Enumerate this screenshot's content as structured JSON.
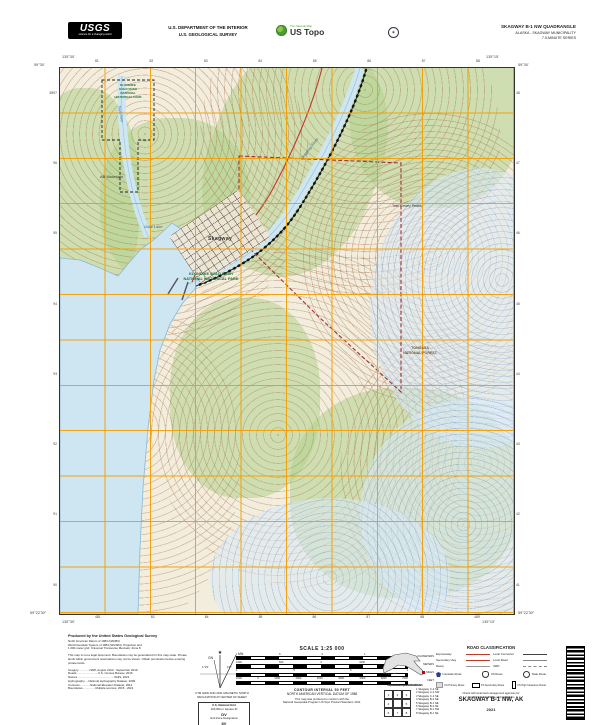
{
  "colors": {
    "grid_orange": "#F29F05",
    "water_blue": "#CDE6F2",
    "contour_brown": "#A9714B",
    "woodland_green": "#B1D18C",
    "park_green": "#1E6B2E",
    "boundary_red": "#A03232",
    "road_red": "#C0392B",
    "ustopo_green": "#4C9F38"
  },
  "header": {
    "usgs_logo": "USGS",
    "usgs_tagline": "science for a changing world",
    "dept_line1": "U.S. DEPARTMENT OF THE INTERIOR",
    "dept_line2": "U.S. GEOLOGICAL SURVEY",
    "ustopo_topline": "The National Map",
    "ustopo_brand": "US Topo",
    "quad_title": "SKAGWAY B-1 NW QUADRANGLE",
    "quad_subtitle1": "ALASKA - SKAGWAY MUNICIPALITY",
    "quad_subtitle2": "7.5-MINUTE SERIES"
  },
  "map": {
    "corners": {
      "tl_lat": "59°30'",
      "tl_lon": "135°30'",
      "tr_lat": "59°30'",
      "tr_lon": "135°15'",
      "bl_lat": "59°22'30\"",
      "bl_lon": "135°30'",
      "br_lat": "59°22'30\"",
      "br_lon": "135°15'"
    },
    "grid_labels": {
      "top": [
        "81",
        "82",
        "83",
        "84",
        "85",
        "86",
        "87",
        "88"
      ],
      "bottom": [
        "481",
        "83",
        "84",
        "85",
        "86",
        "87",
        "88",
        "489"
      ],
      "left": [
        "6597",
        "96",
        "95",
        "94",
        "93",
        "92",
        "91",
        "90"
      ],
      "right": [
        "48",
        "47",
        "46",
        "45",
        "44",
        "43",
        "42",
        "41"
      ]
    },
    "features": {
      "town": "Skagway",
      "goat_lake": "Goat Lake",
      "ab_mountain": "AB Mountain",
      "twin_dewey": "Twin Dewey Peaks",
      "skagway_river": "Skagway River",
      "taiya_river": "Taiya River",
      "park_lines": [
        "KLONDIKE",
        "GOLD RUSH",
        "NATIONAL",
        "HISTORICAL PARK"
      ],
      "park_main": [
        "KLONDIKE GOLD RUSH",
        "NATIONAL HISTORICAL PARK"
      ],
      "tongass": [
        "TONGASS",
        "NATIONAL FOREST"
      ]
    }
  },
  "footer": {
    "produced_by": "Produced by the United States Geological Survey",
    "datum_lines": [
      "North American Datum of 1983 (NAD83)",
      "World Geodetic System of 1984 (WGS84). Projection and",
      "1 000-meter grid: Universal Transverse Mercator, Zone 8"
    ],
    "disclaimer": "This map is not a legal document. Boundaries may be generalized for this map scale. Private lands within government reservations may not be shown. Obtain permission before entering private lands.",
    "credits": [
      "Imagery..............NAIP, August 2013 - September 2019",
      "Roads...........................U.S. Census Bureau, 2016",
      "Names..............................................GNIS, 2021",
      "Hydrography.....National Hydrography Dataset, 2009",
      "Contours.............National Elevation Dataset, 2012",
      "Boundaries................Multiple sources, 2015 - 2021"
    ],
    "declination": {
      "mn": "MN",
      "gn": "GN",
      "mn_angle": "19°",
      "gn_angle": "1°21'",
      "caption": [
        "UTM GRID AND 2021 MAGNETIC NORTH",
        "DECLINATION AT CENTER OF SHEET"
      ]
    },
    "usng": {
      "title": "U.S. National Grid",
      "sub": "100,000-m Square ID",
      "square": "DV",
      "zone_label": "Grid Zone Designation",
      "zone": "8V"
    },
    "scale": {
      "title": "SCALE 1:25 000",
      "bars": [
        {
          "unit": "KILOMETERS",
          "ticks": [
            "1",
            ".5",
            "0",
            "1",
            "2"
          ]
        },
        {
          "unit": "METERS",
          "ticks": [
            "1000",
            "500",
            "0",
            "1000",
            "2000"
          ]
        },
        {
          "unit": "MILES",
          "ticks": [
            "1",
            ".5",
            "0",
            "1"
          ]
        },
        {
          "unit": "FEET",
          "ticks": [
            "1000",
            "0",
            "1000",
            "2000",
            "3000",
            "4000",
            "5000",
            "6000",
            "7000"
          ]
        }
      ],
      "contour": "CONTOUR INTERVAL 50 FEET",
      "vdatum": "NORTH AMERICAN VERTICAL DATUM OF 1988",
      "standard": [
        "This map was produced to conform with the",
        "National Geospatial Program US Topo Product Standard, 2011."
      ]
    },
    "locator": {
      "caption": "QUADRANGLE LOCATION"
    },
    "adjoining": {
      "title": "ADJOINING QUADRANGLES",
      "cells": [
        "1",
        "2",
        "3",
        "4",
        "5",
        "6",
        "7",
        "8"
      ],
      "items": [
        "1  Skagway C-2 SE",
        "2  Skagway C-1 SW",
        "3  Skagway C-1 SE",
        "4  Skagway B-2 NE",
        "5  Skagway B-1 NE",
        "6  Skagway B-2 SE",
        "7  Skagway B-1 SW",
        "8  Skagway B-1 SE"
      ]
    },
    "legend": {
      "title": "ROAD CLASSIFICATION",
      "rows": [
        {
          "l": "Expressway",
          "r": "Local Connector"
        },
        {
          "l": "Secondary Hwy",
          "r": "Local Road"
        },
        {
          "l": "Ramp",
          "r": "4WD"
        }
      ],
      "shields": [
        "Interstate Route",
        "US Route",
        "State Route"
      ],
      "fs_routes": [
        "FS Primary Route",
        "FS Secondary Route",
        "FS High Clearance Route"
      ],
      "note": [
        "Check with local land management agencies for",
        "current route conditions and restrictions"
      ]
    },
    "map_name": "SKAGWAY B-1 NW, AK",
    "year": "2021"
  }
}
